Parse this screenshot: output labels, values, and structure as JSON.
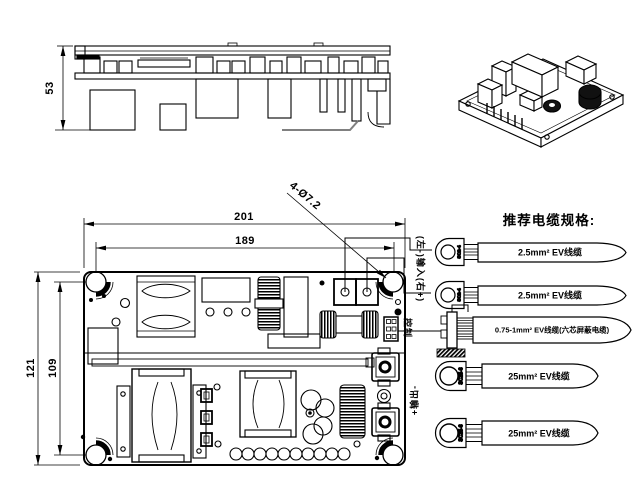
{
  "side_view": {
    "height_dim": "53"
  },
  "top_view": {
    "width_dim": "201",
    "hole_pitch_h_dim": "189",
    "height_dim": "121",
    "hole_pitch_v_dim": "109",
    "hole_callout": "4-Ø7.2"
  },
  "cable_panel": {
    "title": "推荐电缆规格:",
    "input_polarity_label": "(左-)输入(右+)",
    "control_label": "控制",
    "output_polarity_label": "+输出-",
    "cables": [
      {
        "lug": "SC2-4",
        "label": "2.5mm² EV线缆"
      },
      {
        "lug": "SC2-4",
        "label": "2.5mm² EV线缆"
      },
      {
        "lug": "",
        "label": "0.75-1mm² EV线缆(六芯屏蔽电缆)"
      },
      {
        "lug": "SC25-6",
        "label": "25mm² EV线缆"
      },
      {
        "lug": "SC25-6",
        "label": "25mm² EV线缆"
      }
    ]
  },
  "colors": {
    "line": "#000000",
    "harness_gray": "#808080"
  }
}
